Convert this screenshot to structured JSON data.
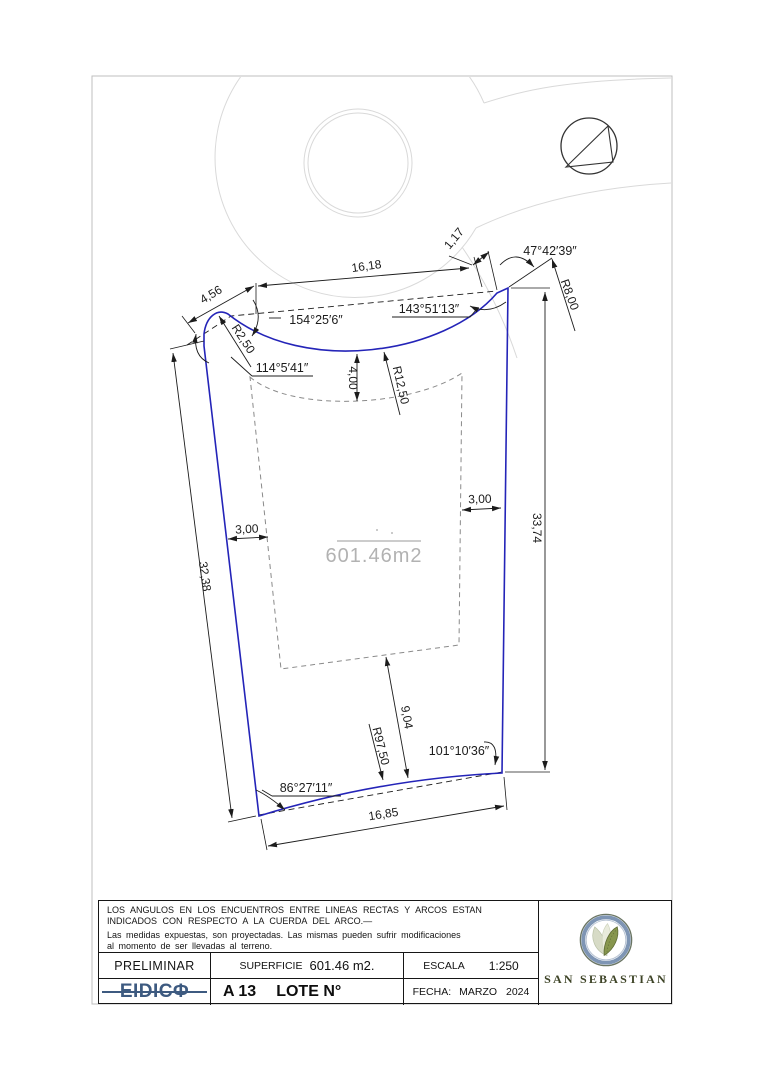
{
  "plan": {
    "area_label": "601.46m2",
    "colors": {
      "lot_boundary": "#2424b8",
      "dimension_lines": "#1c1c1c",
      "street_lines": "#d9d9d9",
      "envelope_dashed": "#8a8a8a",
      "area_text": "#b2b2b2"
    },
    "dims": {
      "top_chord": "16,18",
      "top_small": "1,17",
      "top_left_seg": "4,56",
      "left_side": "32,38",
      "right_side": "33,74",
      "bottom_chord": "16,85",
      "depth_mid": "9,04",
      "front_offset": "4,00",
      "left_offset": "3,00",
      "right_offset": "3,00",
      "r_front": "R12,50",
      "r_corner_left": "R2,50",
      "r_corner_right": "R8,00",
      "r_back": "R97,50"
    },
    "angles": {
      "corner_ext": "47°42′39″",
      "front_left": "154°25′6″",
      "front_right": "143°51′13″",
      "left_top": "114°5′41″",
      "back_left": "86°27′11″",
      "back_right": "101°10′36″"
    }
  },
  "titleblock": {
    "notes": {
      "line1": "LOS ANGULOS EN LOS ENCUENTROS ENTRE LINEAS RECTAS Y ARCOS ESTAN\nINDICADOS CON RESPECTO A LA CUERDA DEL ARCO.—",
      "line2": "Las medidas expuestas, son proyectadas. Las mismas pueden sufrir modificaciones\nal momento de ser llevadas al terreno."
    },
    "status": "PRELIMINAR",
    "superficie": {
      "label": "SUPERFICIE",
      "value": "601.46 m2."
    },
    "escala": {
      "label": "ESCALA",
      "value": "1:250"
    },
    "eidico_logo": "EIDICΦ",
    "lot": {
      "code": "A 13",
      "label": "LOTE N°"
    },
    "fecha": {
      "label": "FECHA:",
      "value": "MARZO 2024"
    },
    "brand": "SAN SEBASTIAN"
  }
}
